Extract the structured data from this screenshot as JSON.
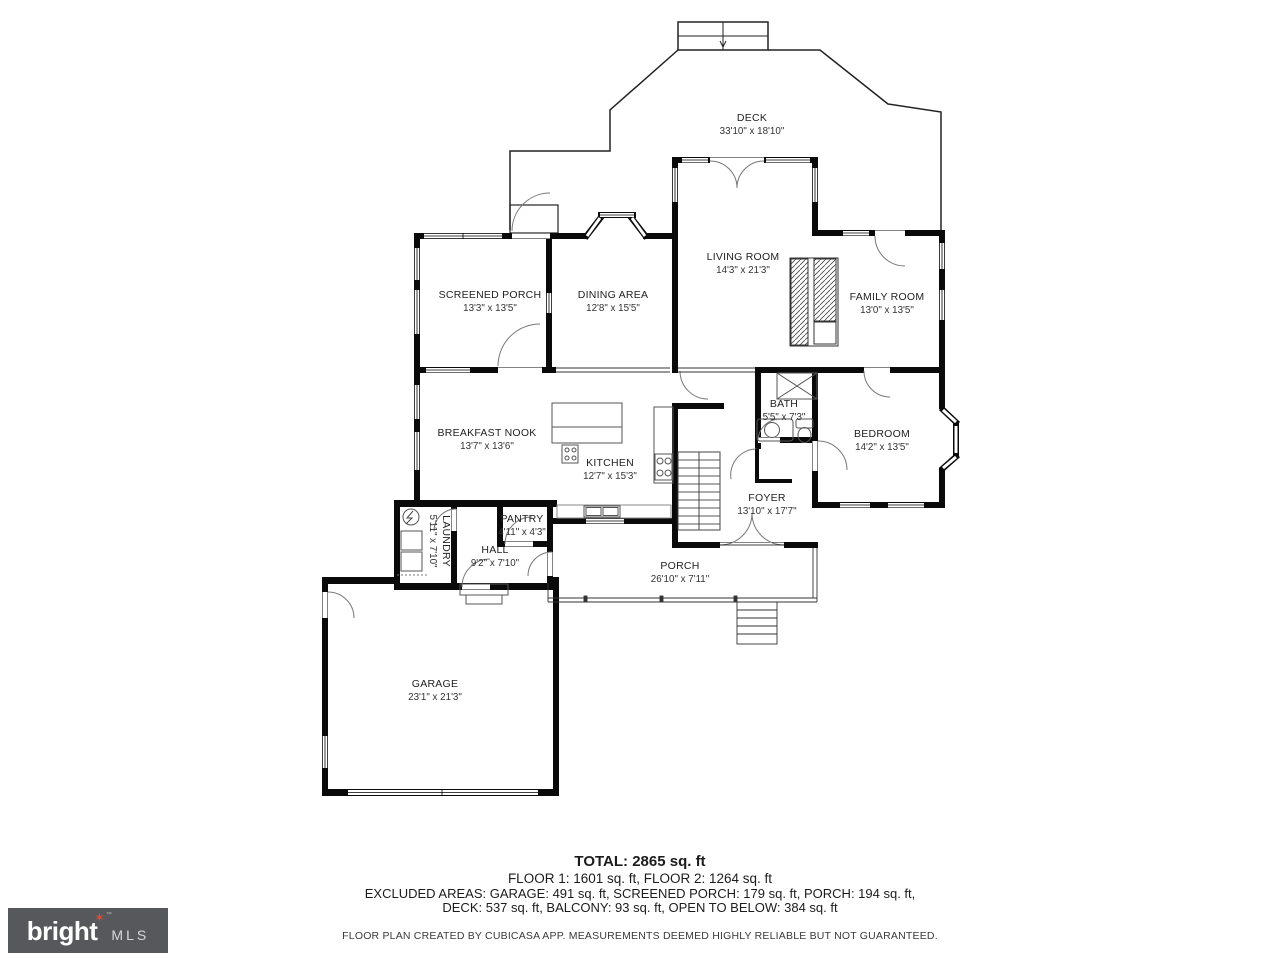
{
  "rooms": [
    {
      "name": "DECK",
      "dims": "33'10\" x 18'10\""
    },
    {
      "name": "LIVING ROOM",
      "dims": "14'3\" x 21'3\""
    },
    {
      "name": "FAMILY ROOM",
      "dims": "13'0\" x 13'5\""
    },
    {
      "name": "SCREENED PORCH",
      "dims": "13'3\" x 13'5\""
    },
    {
      "name": "DINING AREA",
      "dims": "12'8\" x 15'5\""
    },
    {
      "name": "BREAKFAST NOOK",
      "dims": "13'7\" x 13'6\""
    },
    {
      "name": "KITCHEN",
      "dims": "12'7\" x 15'3\""
    },
    {
      "name": "BATH",
      "dims": "5'5\" x 7'3\""
    },
    {
      "name": "BEDROOM",
      "dims": "14'2\" x 13'5\""
    },
    {
      "name": "FOYER",
      "dims": "13'10\" x 17'7\""
    },
    {
      "name": "PANTRY",
      "dims": "4'11\" x 4'3\""
    },
    {
      "name": "HALL",
      "dims": "9'2\" x 7'10\""
    },
    {
      "name": "LAUNDRY",
      "dims": "5'11\" x 7'10\""
    },
    {
      "name": "PORCH",
      "dims": "26'10\" x 7'11\""
    },
    {
      "name": "GARAGE",
      "dims": "23'1\" x 21'3\""
    }
  ],
  "summary": {
    "total": "TOTAL: 2865 sq. ft",
    "floors": "FLOOR 1: 1601 sq. ft, FLOOR 2: 1264 sq. ft",
    "excluded_line1": "EXCLUDED AREAS: GARAGE: 491 sq. ft, SCREENED PORCH: 179 sq. ft, PORCH: 194 sq. ft,",
    "excluded_line2": "DECK: 537 sq. ft, BALCONY: 93 sq. ft, OPEN TO BELOW: 384 sq. ft",
    "disclaimer": "FLOOR PLAN CREATED BY CUBICASA APP. MEASUREMENTS DEEMED HIGHLY RELIABLE BUT NOT GUARANTEED."
  },
  "logo": {
    "brand": "bright",
    "suffix": "MLS",
    "tm": "TM",
    "star": "✶",
    "box_color": "#57585c",
    "star_color": "#d94f38"
  }
}
